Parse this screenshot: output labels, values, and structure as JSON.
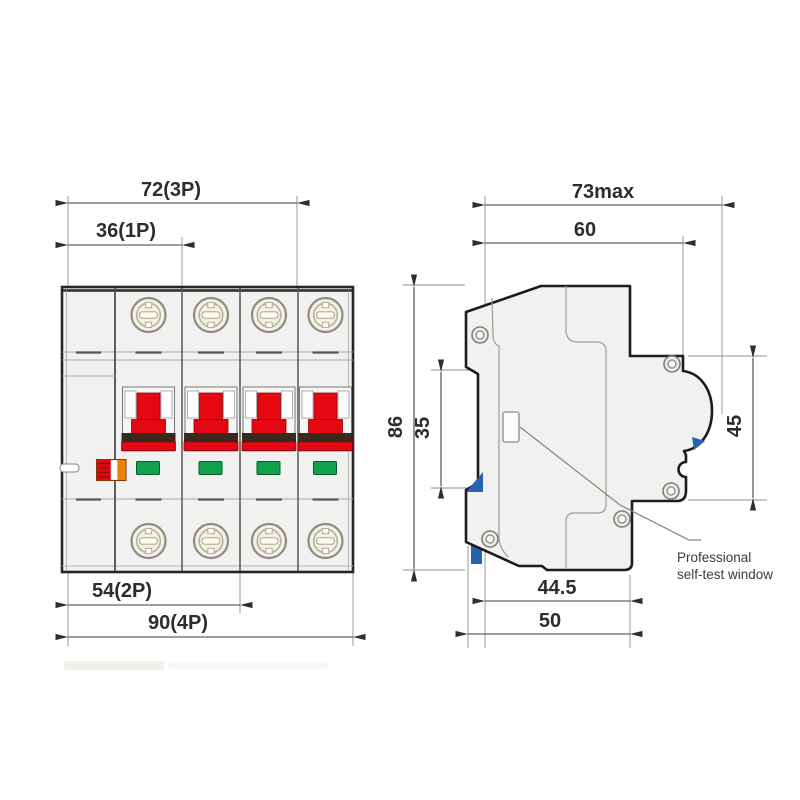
{
  "front": {
    "view_name": "front-view",
    "dim_1p": "36(1P)",
    "dim_3p": "72(3P)",
    "dim_2p": "54(2P)",
    "dim_4p": "90(4P)"
  },
  "side": {
    "view_name": "side-view",
    "dim_width_max": "73max",
    "dim_width_top": "60",
    "dim_height": "86",
    "dim_din_window": "35",
    "dim_front_face": "45",
    "dim_depth_body": "44.5",
    "dim_depth_total": "50",
    "note_line1": "Professional",
    "note_line2": "self-test window"
  },
  "colors": {
    "handle_red": "#e50813",
    "band_dark": "#3a291d",
    "indicator_green": "#0fa24a",
    "flag_orange": "#f18101",
    "clip_blue": "#2563ae",
    "body_fill": "#f1f1ef",
    "screw_face": "#f3f1e3",
    "outline": "#262626"
  }
}
